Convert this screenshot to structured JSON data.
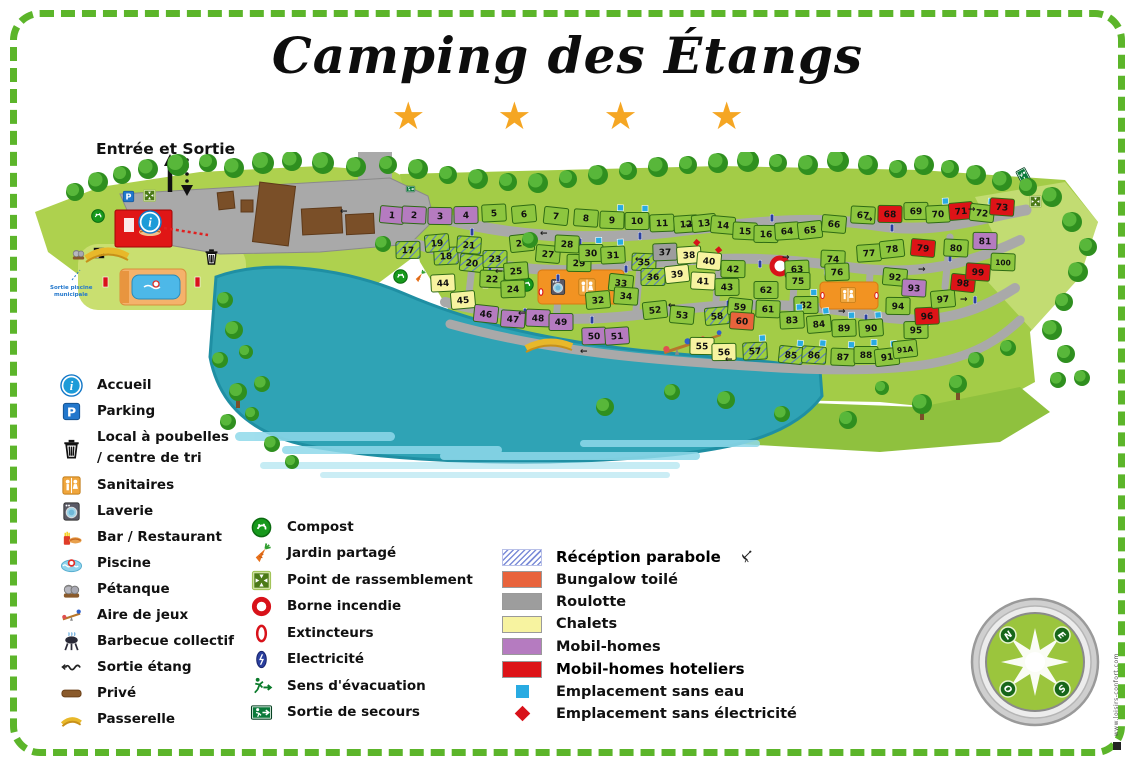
{
  "title": "Camping des Étangs",
  "stars": "★ ★ ★ ★",
  "map": {
    "entrance_label": "Entrée et Sortie",
    "pool_exit_line1": "Sortie piscine",
    "pool_exit_line2": "municipale"
  },
  "compass": {
    "nw": "N",
    "ne": "E",
    "se": "S",
    "sw": "O"
  },
  "credit": "www.loisirs-confort.com",
  "colors": {
    "green_plot": "#8dc63f",
    "mobil_home": "#b57bc0",
    "mobil_home_hotelier": "#dd1317",
    "chalet": "#f7f3a0",
    "bungalow": "#e8633c",
    "roulotte": "#9d9d9d",
    "water_marker": "#29abe2",
    "elec_marker": "#d8121a",
    "road": "#a9a9a9",
    "lake": "#2fa3b5",
    "border_green": "#5cb52a",
    "star": "#f5a623"
  },
  "legend": {
    "left": [
      {
        "icon": "ic-info",
        "label": "Accueil"
      },
      {
        "icon": "ic-parking",
        "label": "Parking"
      },
      {
        "icon": "ic-trash",
        "label": "Local à poubelles",
        "label2": "/ centre de tri"
      },
      {
        "icon": "ic-sanitaires",
        "label": "Sanitaires"
      },
      {
        "icon": "ic-laverie",
        "label": "Laverie"
      },
      {
        "icon": "ic-bar",
        "label": "Bar / Restaurant"
      },
      {
        "icon": "ic-piscine",
        "label": "Piscine"
      },
      {
        "icon": "ic-petanque",
        "label": "Pétanque"
      },
      {
        "icon": "ic-jeux",
        "label": "Aire de jeux"
      },
      {
        "icon": "ic-barbecue",
        "label": "Barbecue collectif"
      },
      {
        "icon": "ic-sortie-etang",
        "label": "Sortie étang"
      },
      {
        "icon": "ic-prive",
        "label": "Privé"
      },
      {
        "icon": "ic-passerelle",
        "label": "Passerelle"
      }
    ],
    "middle": [
      {
        "icon": "ic-compost",
        "label": "Compost"
      },
      {
        "icon": "ic-jardin",
        "label": "Jardin partagé"
      },
      {
        "icon": "ic-rassemblement",
        "label": "Point de rassemblement"
      },
      {
        "icon": "ic-borne",
        "label": "Borne incendie"
      },
      {
        "icon": "ic-extincteur",
        "label": "Extincteurs"
      },
      {
        "icon": "ic-electricite",
        "label": "Electricité"
      },
      {
        "icon": "ic-evacuation",
        "label": "Sens d'évacuation"
      },
      {
        "icon": "ic-secours",
        "label": "Sortie de secours"
      }
    ],
    "right": [
      {
        "swatch": "hatch",
        "label": "Récéption parabole",
        "bold": true,
        "dish": true
      },
      {
        "swatch": "#e8633c",
        "label": "Bungalow toilé"
      },
      {
        "swatch": "#9d9d9d",
        "label": "Roulotte"
      },
      {
        "swatch": "#f7f3a0",
        "label": "Chalets"
      },
      {
        "swatch": "#b57bc0",
        "label": "Mobil-homes"
      },
      {
        "swatch": "#dd1317",
        "label": "Mobil-homes hoteliers",
        "bold": true
      },
      {
        "swatch": "sqblue",
        "label": "Emplacement sans eau"
      },
      {
        "swatch": "diared",
        "label": "Emplacement sans électricité"
      }
    ]
  },
  "plots": [
    [
      "1",
      372,
      63,
      "p",
      ""
    ],
    [
      "2",
      394,
      63,
      "p",
      ""
    ],
    [
      "3",
      420,
      64,
      "p",
      ""
    ],
    [
      "4",
      446,
      63,
      "p",
      ""
    ],
    [
      "5",
      474,
      61,
      "g",
      ""
    ],
    [
      "6",
      504,
      62,
      "g",
      ""
    ],
    [
      "7",
      536,
      64,
      "g",
      ""
    ],
    [
      "8",
      566,
      66,
      "g",
      ""
    ],
    [
      "9",
      592,
      68,
      "g",
      "w"
    ],
    [
      "10",
      617,
      69,
      "g",
      "w"
    ],
    [
      "11",
      642,
      71,
      "g",
      ""
    ],
    [
      "12",
      666,
      72,
      "g",
      ""
    ],
    [
      "13",
      684,
      71,
      "g",
      ""
    ],
    [
      "14",
      703,
      73,
      "g",
      ""
    ],
    [
      "15",
      725,
      79,
      "g",
      ""
    ],
    [
      "16",
      746,
      82,
      "g",
      ""
    ],
    [
      "17",
      388,
      98,
      "h",
      ""
    ],
    [
      "18",
      426,
      104,
      "h",
      ""
    ],
    [
      "19",
      417,
      91,
      "h",
      ""
    ],
    [
      "20",
      452,
      111,
      "h",
      ""
    ],
    [
      "21",
      449,
      93,
      "h",
      ""
    ],
    [
      "22",
      472,
      127,
      "g",
      ""
    ],
    [
      "23",
      475,
      107,
      "h",
      ""
    ],
    [
      "24",
      493,
      137,
      "g",
      ""
    ],
    [
      "25",
      496,
      119,
      "g",
      ""
    ],
    [
      "26",
      502,
      91,
      "g",
      ""
    ],
    [
      "27",
      528,
      102,
      "g",
      ""
    ],
    [
      "28",
      547,
      92,
      "g",
      ""
    ],
    [
      "29",
      559,
      111,
      "g",
      ""
    ],
    [
      "30",
      571,
      101,
      "g",
      "w"
    ],
    [
      "31",
      593,
      103,
      "g",
      "w"
    ],
    [
      "32",
      578,
      148,
      "g",
      ""
    ],
    [
      "33",
      601,
      131,
      "g",
      ""
    ],
    [
      "34",
      606,
      144,
      "g",
      ""
    ],
    [
      "35",
      624,
      110,
      "h",
      ""
    ],
    [
      "36",
      633,
      125,
      "h",
      ""
    ],
    [
      "37",
      645,
      100,
      "s",
      ""
    ],
    [
      "38",
      669,
      103,
      "y",
      "e"
    ],
    [
      "39",
      657,
      122,
      "y",
      ""
    ],
    [
      "40",
      689,
      109,
      "y",
      "e"
    ],
    [
      "41",
      683,
      129,
      "y",
      ""
    ],
    [
      "42",
      713,
      117,
      "g",
      ""
    ],
    [
      "43",
      707,
      135,
      "g",
      ""
    ],
    [
      "44",
      423,
      131,
      "y",
      ""
    ],
    [
      "45",
      443,
      148,
      "y",
      ""
    ],
    [
      "46",
      466,
      162,
      "p",
      ""
    ],
    [
      "47",
      493,
      167,
      "p",
      ""
    ],
    [
      "48",
      518,
      166,
      "p",
      ""
    ],
    [
      "49",
      541,
      170,
      "p",
      ""
    ],
    [
      "50",
      574,
      184,
      "p",
      ""
    ],
    [
      "51",
      597,
      184,
      "p",
      ""
    ],
    [
      "52",
      635,
      158,
      "g",
      ""
    ],
    [
      "53",
      662,
      163,
      "g",
      ""
    ],
    [
      "55",
      682,
      194,
      "y",
      ""
    ],
    [
      "56",
      704,
      200,
      "y",
      ""
    ],
    [
      "57",
      735,
      199,
      "h",
      "w"
    ],
    [
      "58",
      697,
      164,
      "h",
      ""
    ],
    [
      "59",
      720,
      155,
      "g",
      ""
    ],
    [
      "60",
      722,
      169,
      "o",
      ""
    ],
    [
      "61",
      748,
      157,
      "g",
      ""
    ],
    [
      "62",
      746,
      138,
      "g",
      ""
    ],
    [
      "63",
      777,
      117,
      "g",
      ""
    ],
    [
      "64",
      767,
      79,
      "g",
      ""
    ],
    [
      "65",
      790,
      78,
      "g",
      ""
    ],
    [
      "66",
      814,
      72,
      "g",
      ""
    ],
    [
      "67",
      843,
      63,
      "g",
      ""
    ],
    [
      "68",
      870,
      62,
      "r",
      ""
    ],
    [
      "69",
      896,
      59,
      "g",
      ""
    ],
    [
      "70",
      918,
      62,
      "g",
      "w"
    ],
    [
      "71",
      941,
      59,
      "r",
      ""
    ],
    [
      "72",
      962,
      61,
      "g",
      "w"
    ],
    [
      "73",
      982,
      55,
      "r",
      ""
    ],
    [
      "74",
      813,
      107,
      "g",
      ""
    ],
    [
      "75",
      778,
      129,
      "g",
      ""
    ],
    [
      "76",
      817,
      120,
      "g",
      ""
    ],
    [
      "77",
      849,
      101,
      "g",
      ""
    ],
    [
      "78",
      872,
      97,
      "g",
      ""
    ],
    [
      "79",
      903,
      96,
      "r",
      ""
    ],
    [
      "80",
      936,
      96,
      "g",
      ""
    ],
    [
      "81",
      965,
      89,
      "p",
      ""
    ],
    [
      "82",
      786,
      153,
      "g",
      "w"
    ],
    [
      "83",
      772,
      168,
      "g",
      "w"
    ],
    [
      "84",
      799,
      172,
      "g",
      "w"
    ],
    [
      "85",
      771,
      203,
      "h",
      "w"
    ],
    [
      "86",
      794,
      203,
      "h",
      "w"
    ],
    [
      "87",
      823,
      205,
      "g",
      "w"
    ],
    [
      "88",
      846,
      203,
      "g",
      "w"
    ],
    [
      "89",
      824,
      176,
      "g",
      "w"
    ],
    [
      "90",
      851,
      176,
      "g",
      "w"
    ],
    [
      "91",
      867,
      205,
      "g",
      "w"
    ],
    [
      "91A",
      885,
      197,
      "g",
      "e"
    ],
    [
      "92",
      875,
      125,
      "g",
      ""
    ],
    [
      "93",
      894,
      136,
      "p",
      ""
    ],
    [
      "94",
      878,
      154,
      "g",
      ""
    ],
    [
      "95",
      896,
      178,
      "g",
      ""
    ],
    [
      "96",
      907,
      164,
      "r",
      ""
    ],
    [
      "97",
      923,
      147,
      "g",
      ""
    ],
    [
      "98",
      943,
      131,
      "r",
      ""
    ],
    [
      "99",
      958,
      120,
      "r",
      ""
    ],
    [
      "100",
      983,
      110,
      "g",
      ""
    ]
  ]
}
